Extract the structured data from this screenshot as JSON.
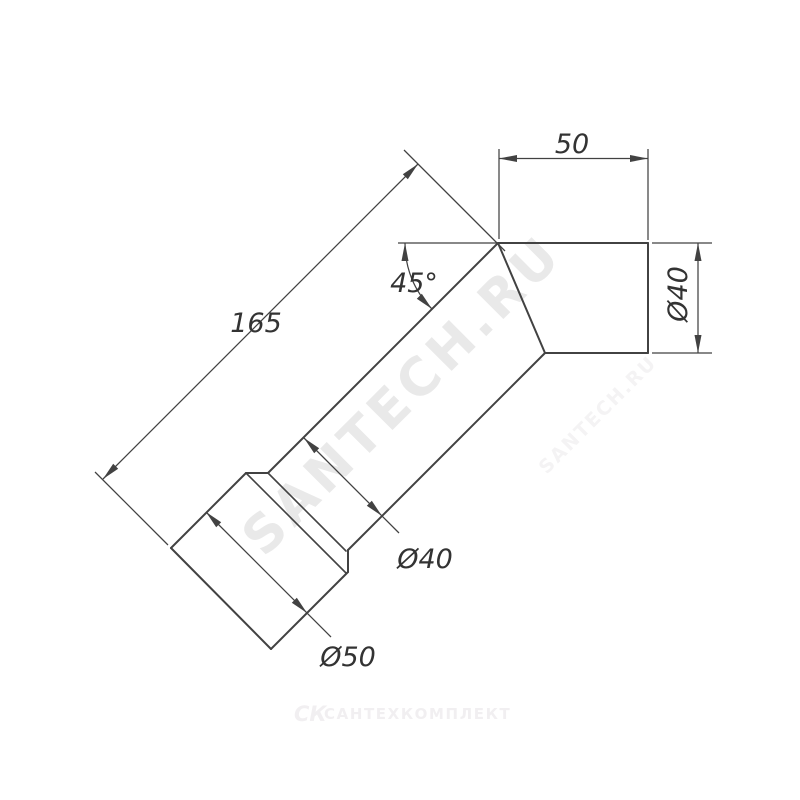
{
  "page": {
    "background": "#ffffff"
  },
  "drawing": {
    "description": "Technical dimension drawing of a 45-degree elbow pipe fitting with socket end",
    "line_color": "#424242",
    "label_color": "#333333",
    "labels": {
      "overall_length": "165",
      "outlet_length": "50",
      "bend_angle": "45°",
      "outlet_diameter": "Ø40",
      "body_diameter": "Ø40",
      "socket_diameter": "Ø50"
    }
  },
  "watermarks": {
    "primary": {
      "text": "SANTECH.RU",
      "color": "#e9e9e9"
    },
    "secondary": {
      "text": "SANTECH.RU",
      "color": "#f4f3f4"
    }
  },
  "footer": {
    "logo_mark": "СК",
    "logo_text": "САНТЕХКОМПЛЕКТ",
    "color": "#f1eff1"
  }
}
